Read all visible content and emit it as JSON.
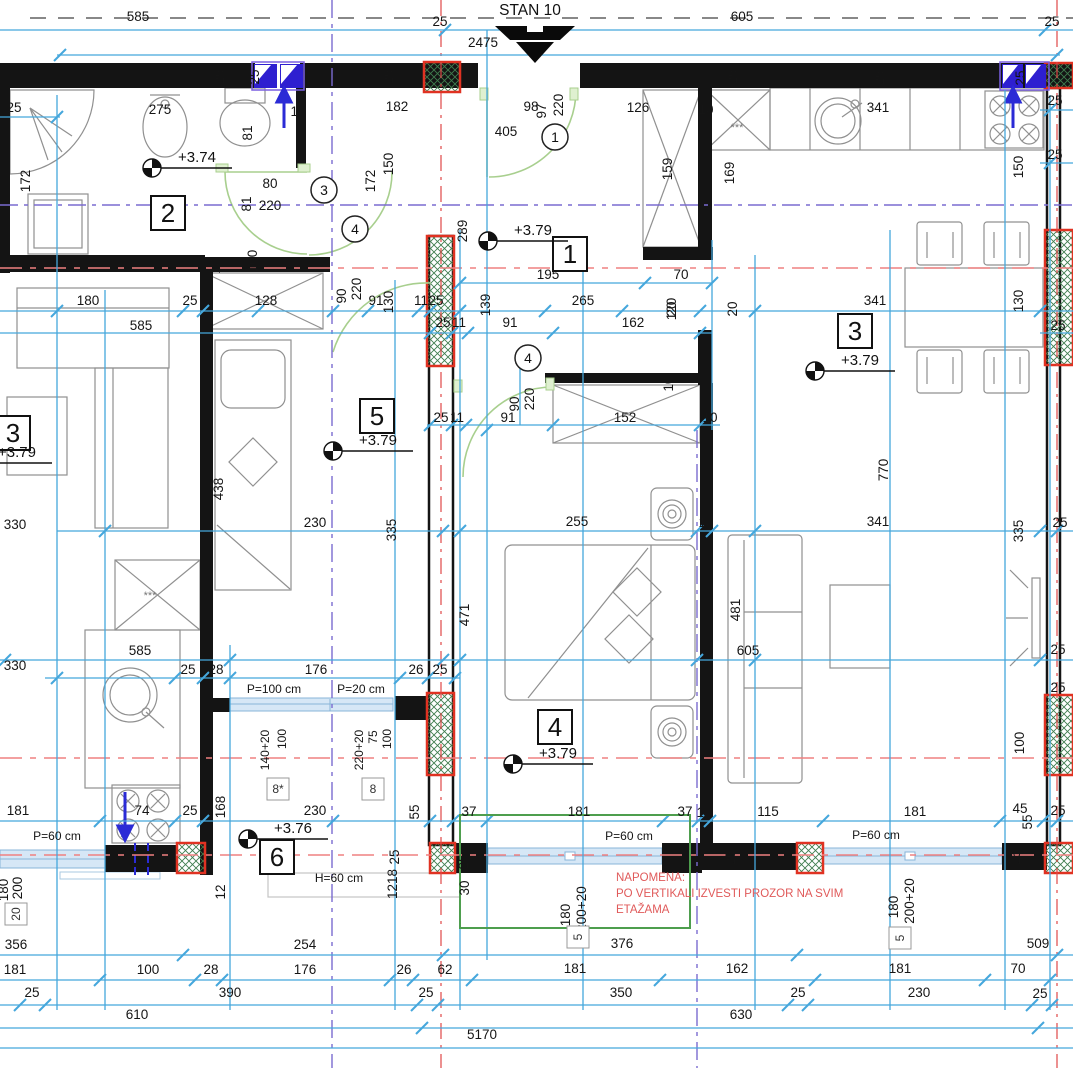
{
  "title": "STAN 10",
  "colors": {
    "dimension": "#45a7dc",
    "axis_red": "#e04848",
    "axis_purple": "#7a6bd0",
    "section_red": "#ef8080",
    "door_green": "#a8cf8e",
    "note_red": "#e05a5a",
    "shaft_blue": "#2e1fd0",
    "column_red": "#e03222",
    "hatch_green": "#3f7d4e",
    "window_fill": "#d6e7f6",
    "window_stroke": "#88b4d8",
    "wall": "#141414",
    "furniture": "#909090"
  },
  "note": {
    "x": 616,
    "y": 881,
    "line_h": 16,
    "lines": [
      "NAPOMENA:",
      "PO VERTIKALI IZVESTI PROZOR NA SVIM",
      "ETAŽAMA"
    ]
  },
  "room_labels": [
    {
      "n": "2",
      "x": 168,
      "y": 213
    },
    {
      "n": "1",
      "x": 570,
      "y": 254
    },
    {
      "n": "3",
      "x": 855,
      "y": 331
    },
    {
      "n": "3",
      "x": 13,
      "y": 433
    },
    {
      "n": "5",
      "x": 377,
      "y": 416
    },
    {
      "n": "4",
      "x": 555,
      "y": 727
    },
    {
      "n": "6",
      "x": 277,
      "y": 857
    }
  ],
  "level_marks": [
    {
      "t": "+3.74",
      "x": 152,
      "y": 168
    },
    {
      "t": "+3.79",
      "x": 488,
      "y": 241
    },
    {
      "t": "+3.79",
      "x": 815,
      "y": 371
    },
    {
      "t": "+3.79",
      "x": 333,
      "y": 451
    },
    {
      "t": "+3.79",
      "x": 513,
      "y": 764
    },
    {
      "t": "+3.76",
      "x": 248,
      "y": 839
    },
    {
      "t": "+3.79",
      "x": -28,
      "y": 463
    }
  ],
  "door_circles": [
    {
      "n": "1",
      "x": 555,
      "y": 137
    },
    {
      "n": "3",
      "x": 324,
      "y": 190
    },
    {
      "n": "4",
      "x": 355,
      "y": 229
    },
    {
      "n": "4",
      "x": 528,
      "y": 358
    }
  ],
  "window_id_boxes": [
    {
      "t": "8*",
      "x": 278,
      "y": 789
    },
    {
      "t": "8",
      "x": 373,
      "y": 789
    },
    {
      "t": "5",
      "x": 578,
      "y": 937,
      "r": 1
    },
    {
      "t": "5",
      "x": 900,
      "y": 938,
      "r": 1
    },
    {
      "t": "20",
      "x": 16,
      "y": 914,
      "r": 1
    }
  ],
  "annotations": [
    {
      "t": "585",
      "x": 138,
      "y": 21
    },
    {
      "t": "25",
      "x": 440,
      "y": 26
    },
    {
      "t": "2475",
      "x": 483,
      "y": 47
    },
    {
      "t": "605",
      "x": 742,
      "y": 21
    },
    {
      "t": "25",
      "x": 1052,
      "y": 26
    },
    {
      "t": "25",
      "x": 14,
      "y": 112
    },
    {
      "t": "275",
      "x": 160,
      "y": 114
    },
    {
      "t": "172",
      "x": 30,
      "y": 181,
      "r": 1
    },
    {
      "t": "81",
      "x": 252,
      "y": 133,
      "r": 1
    },
    {
      "t": "81",
      "x": 251,
      "y": 204,
      "r": 1
    },
    {
      "t": "100",
      "x": 257,
      "y": 261,
      "r": 1
    },
    {
      "t": "10",
      "x": 220,
      "y": 266,
      "r": 1
    },
    {
      "t": "80",
      "x": 270,
      "y": 188
    },
    {
      "t": "220",
      "x": 270,
      "y": 210
    },
    {
      "t": "10",
      "x": 298,
      "y": 116
    },
    {
      "t": "25",
      "x": 224,
      "y": 77,
      "r": 1
    },
    {
      "t": "25",
      "x": 259,
      "y": 77,
      "r": 1
    },
    {
      "t": "25",
      "x": 393,
      "y": 77,
      "r": 1
    },
    {
      "t": "182",
      "x": 397,
      "y": 111
    },
    {
      "t": "150",
      "x": 393,
      "y": 164,
      "r": 1
    },
    {
      "t": "172",
      "x": 375,
      "y": 181,
      "r": 1
    },
    {
      "t": "98",
      "x": 531,
      "y": 111
    },
    {
      "t": "97",
      "x": 546,
      "y": 111,
      "r": 1
    },
    {
      "t": "220",
      "x": 563,
      "y": 105,
      "r": 1
    },
    {
      "t": "405",
      "x": 506,
      "y": 136
    },
    {
      "t": "289",
      "x": 467,
      "y": 231,
      "r": 1
    },
    {
      "t": "195",
      "x": 548,
      "y": 279
    },
    {
      "t": "70",
      "x": 681,
      "y": 279
    },
    {
      "t": "126",
      "x": 638,
      "y": 112
    },
    {
      "t": "10",
      "x": 706,
      "y": 114
    },
    {
      "t": "159",
      "x": 672,
      "y": 169,
      "r": 1
    },
    {
      "t": "169",
      "x": 734,
      "y": 173,
      "r": 1
    },
    {
      "t": "341",
      "x": 878,
      "y": 112
    },
    {
      "t": "25",
      "x": 737,
      "y": 77,
      "r": 1
    },
    {
      "t": "25",
      "x": 884,
      "y": 78,
      "r": 1
    },
    {
      "t": "25",
      "x": 1025,
      "y": 78,
      "r": 1
    },
    {
      "t": "25",
      "x": 1055,
      "y": 105
    },
    {
      "t": "25",
      "x": 1055,
      "y": 159
    },
    {
      "t": "150",
      "x": 1023,
      "y": 167,
      "r": 1
    },
    {
      "t": "20",
      "x": 676,
      "y": 309,
      "r": 1
    },
    {
      "t": "20",
      "x": 737,
      "y": 309,
      "r": 1
    },
    {
      "t": "180",
      "x": 88,
      "y": 305
    },
    {
      "t": "25",
      "x": 190,
      "y": 305
    },
    {
      "t": "128",
      "x": 266,
      "y": 305
    },
    {
      "t": "90",
      "x": 346,
      "y": 296,
      "r": 1
    },
    {
      "t": "220",
      "x": 361,
      "y": 289,
      "r": 1
    },
    {
      "t": "91",
      "x": 376,
      "y": 305
    },
    {
      "t": "130",
      "x": 393,
      "y": 302,
      "r": 1
    },
    {
      "t": "11",
      "x": 421,
      "y": 305
    },
    {
      "t": "25",
      "x": 436,
      "y": 305
    },
    {
      "t": "139",
      "x": 490,
      "y": 305,
      "r": 1
    },
    {
      "t": "265",
      "x": 583,
      "y": 305
    },
    {
      "t": "120",
      "x": 676,
      "y": 309,
      "r": 1
    },
    {
      "t": "341",
      "x": 875,
      "y": 305
    },
    {
      "t": "130",
      "x": 1023,
      "y": 301,
      "r": 1
    },
    {
      "t": "585",
      "x": 141,
      "y": 330
    },
    {
      "t": "25",
      "x": 443,
      "y": 327
    },
    {
      "t": "11",
      "x": 459,
      "y": 327
    },
    {
      "t": "91",
      "x": 510,
      "y": 327
    },
    {
      "t": "162",
      "x": 633,
      "y": 327
    },
    {
      "t": "25",
      "x": 1058,
      "y": 330
    },
    {
      "t": "90",
      "x": 519,
      "y": 404,
      "r": 1
    },
    {
      "t": "220",
      "x": 534,
      "y": 399,
      "r": 1
    },
    {
      "t": "25",
      "x": 441,
      "y": 422
    },
    {
      "t": "11",
      "x": 457,
      "y": 422
    },
    {
      "t": "91",
      "x": 508,
      "y": 422
    },
    {
      "t": "152",
      "x": 625,
      "y": 422
    },
    {
      "t": "10",
      "x": 673,
      "y": 384,
      "r": 1
    },
    {
      "t": "10",
      "x": 710,
      "y": 422
    },
    {
      "t": "330",
      "x": 15,
      "y": 529
    },
    {
      "t": "438",
      "x": 223,
      "y": 489,
      "r": 1
    },
    {
      "t": "230",
      "x": 315,
      "y": 527
    },
    {
      "t": "335",
      "x": 396,
      "y": 530,
      "r": 1
    },
    {
      "t": "255",
      "x": 577,
      "y": 526
    },
    {
      "t": "10",
      "x": 706,
      "y": 527
    },
    {
      "t": "341",
      "x": 878,
      "y": 526
    },
    {
      "t": "335",
      "x": 1023,
      "y": 531,
      "r": 1
    },
    {
      "t": "25",
      "x": 1060,
      "y": 527
    },
    {
      "t": "471",
      "x": 469,
      "y": 615,
      "r": 1
    },
    {
      "t": "481",
      "x": 740,
      "y": 610,
      "r": 1
    },
    {
      "t": "605",
      "x": 748,
      "y": 655
    },
    {
      "t": "770",
      "x": 888,
      "y": 470,
      "r": 1
    },
    {
      "t": "25",
      "x": 1058,
      "y": 654
    },
    {
      "t": "25",
      "x": 1058,
      "y": 692
    },
    {
      "t": "100",
      "x": 1024,
      "y": 743,
      "r": 1
    },
    {
      "t": "330",
      "x": 15,
      "y": 670
    },
    {
      "t": "585",
      "x": 140,
      "y": 655
    },
    {
      "t": "25",
      "x": 188,
      "y": 674
    },
    {
      "t": "28",
      "x": 216,
      "y": 674
    },
    {
      "t": "176",
      "x": 316,
      "y": 674
    },
    {
      "t": "26",
      "x": 416,
      "y": 674
    },
    {
      "t": "25",
      "x": 440,
      "y": 674
    },
    {
      "t": "P=100 cm",
      "x": 274,
      "y": 693,
      "s": 12
    },
    {
      "t": "P=20 cm",
      "x": 361,
      "y": 693,
      "s": 12
    },
    {
      "t": "140+20",
      "x": 269,
      "y": 750,
      "r": 1,
      "s": 12
    },
    {
      "t": "100",
      "x": 286,
      "y": 739,
      "r": 1,
      "s": 12
    },
    {
      "t": "220+20",
      "x": 363,
      "y": 750,
      "r": 1,
      "s": 12
    },
    {
      "t": "75",
      "x": 377,
      "y": 737,
      "r": 1,
      "s": 12
    },
    {
      "t": "100",
      "x": 391,
      "y": 739,
      "r": 1,
      "s": 12
    },
    {
      "t": "181",
      "x": 18,
      "y": 815
    },
    {
      "t": "74",
      "x": 142,
      "y": 815
    },
    {
      "t": "25",
      "x": 190,
      "y": 815
    },
    {
      "t": "168",
      "x": 225,
      "y": 807,
      "r": 1
    },
    {
      "t": "230",
      "x": 315,
      "y": 815
    },
    {
      "t": "55",
      "x": 419,
      "y": 812,
      "r": 1
    },
    {
      "t": "37",
      "x": 469,
      "y": 816
    },
    {
      "t": "181",
      "x": 579,
      "y": 816
    },
    {
      "t": "37",
      "x": 685,
      "y": 816
    },
    {
      "t": "10",
      "x": 704,
      "y": 817
    },
    {
      "t": "115",
      "x": 768,
      "y": 816
    },
    {
      "t": "181",
      "x": 915,
      "y": 816
    },
    {
      "t": "45",
      "x": 1020,
      "y": 813
    },
    {
      "t": "55",
      "x": 1032,
      "y": 822,
      "r": 1
    },
    {
      "t": "25",
      "x": 1058,
      "y": 815
    },
    {
      "t": "P=60 cm",
      "x": 57,
      "y": 840,
      "s": 12
    },
    {
      "t": "P=60 cm",
      "x": 629,
      "y": 840,
      "s": 12
    },
    {
      "t": "P=60 cm",
      "x": 876,
      "y": 839,
      "s": 12
    },
    {
      "t": "25",
      "x": 468,
      "y": 862,
      "r": 1
    },
    {
      "t": "30",
      "x": 469,
      "y": 888,
      "r": 1
    },
    {
      "t": "25",
      "x": 735,
      "y": 858,
      "r": 1
    },
    {
      "t": "25",
      "x": 1020,
      "y": 858,
      "r": 1
    },
    {
      "t": "180",
      "x": 570,
      "y": 915,
      "r": 1
    },
    {
      "t": "200+20",
      "x": 586,
      "y": 909,
      "r": 1
    },
    {
      "t": "180",
      "x": 898,
      "y": 907,
      "r": 1
    },
    {
      "t": "200+20",
      "x": 914,
      "y": 901,
      "r": 1
    },
    {
      "t": "12",
      "x": 225,
      "y": 892,
      "r": 1
    },
    {
      "t": "1218",
      "x": 397,
      "y": 884,
      "r": 1
    },
    {
      "t": "25",
      "x": 399,
      "y": 857,
      "r": 1
    },
    {
      "t": "H=60 cm",
      "x": 339,
      "y": 882,
      "s": 12
    },
    {
      "t": "180",
      "x": 8,
      "y": 890,
      "r": 1
    },
    {
      "t": "200",
      "x": 22,
      "y": 888,
      "r": 1
    },
    {
      "t": "356",
      "x": 16,
      "y": 949
    },
    {
      "t": "254",
      "x": 305,
      "y": 949
    },
    {
      "t": "376",
      "x": 622,
      "y": 948
    },
    {
      "t": "509",
      "x": 1038,
      "y": 948
    },
    {
      "t": "181",
      "x": 15,
      "y": 974
    },
    {
      "t": "100",
      "x": 148,
      "y": 974
    },
    {
      "t": "28",
      "x": 211,
      "y": 974
    },
    {
      "t": "176",
      "x": 305,
      "y": 974
    },
    {
      "t": "26",
      "x": 404,
      "y": 974
    },
    {
      "t": "62",
      "x": 445,
      "y": 974
    },
    {
      "t": "181",
      "x": 575,
      "y": 973
    },
    {
      "t": "162",
      "x": 737,
      "y": 973
    },
    {
      "t": "181",
      "x": 900,
      "y": 973
    },
    {
      "t": "70",
      "x": 1018,
      "y": 973
    },
    {
      "t": "25",
      "x": 32,
      "y": 997
    },
    {
      "t": "390",
      "x": 230,
      "y": 997
    },
    {
      "t": "25",
      "x": 426,
      "y": 997
    },
    {
      "t": "350",
      "x": 621,
      "y": 997
    },
    {
      "t": "25",
      "x": 798,
      "y": 997
    },
    {
      "t": "230",
      "x": 919,
      "y": 997
    },
    {
      "t": "25",
      "x": 1040,
      "y": 998
    },
    {
      "t": "610",
      "x": 137,
      "y": 1019
    },
    {
      "t": "630",
      "x": 741,
      "y": 1019
    },
    {
      "t": "5170",
      "x": 482,
      "y": 1039
    },
    {
      "t": "***",
      "x": 737,
      "y": 131,
      "s": 11,
      "c": "#777777"
    },
    {
      "t": "***",
      "x": 150,
      "y": 599,
      "s": 11,
      "c": "#777777"
    }
  ]
}
